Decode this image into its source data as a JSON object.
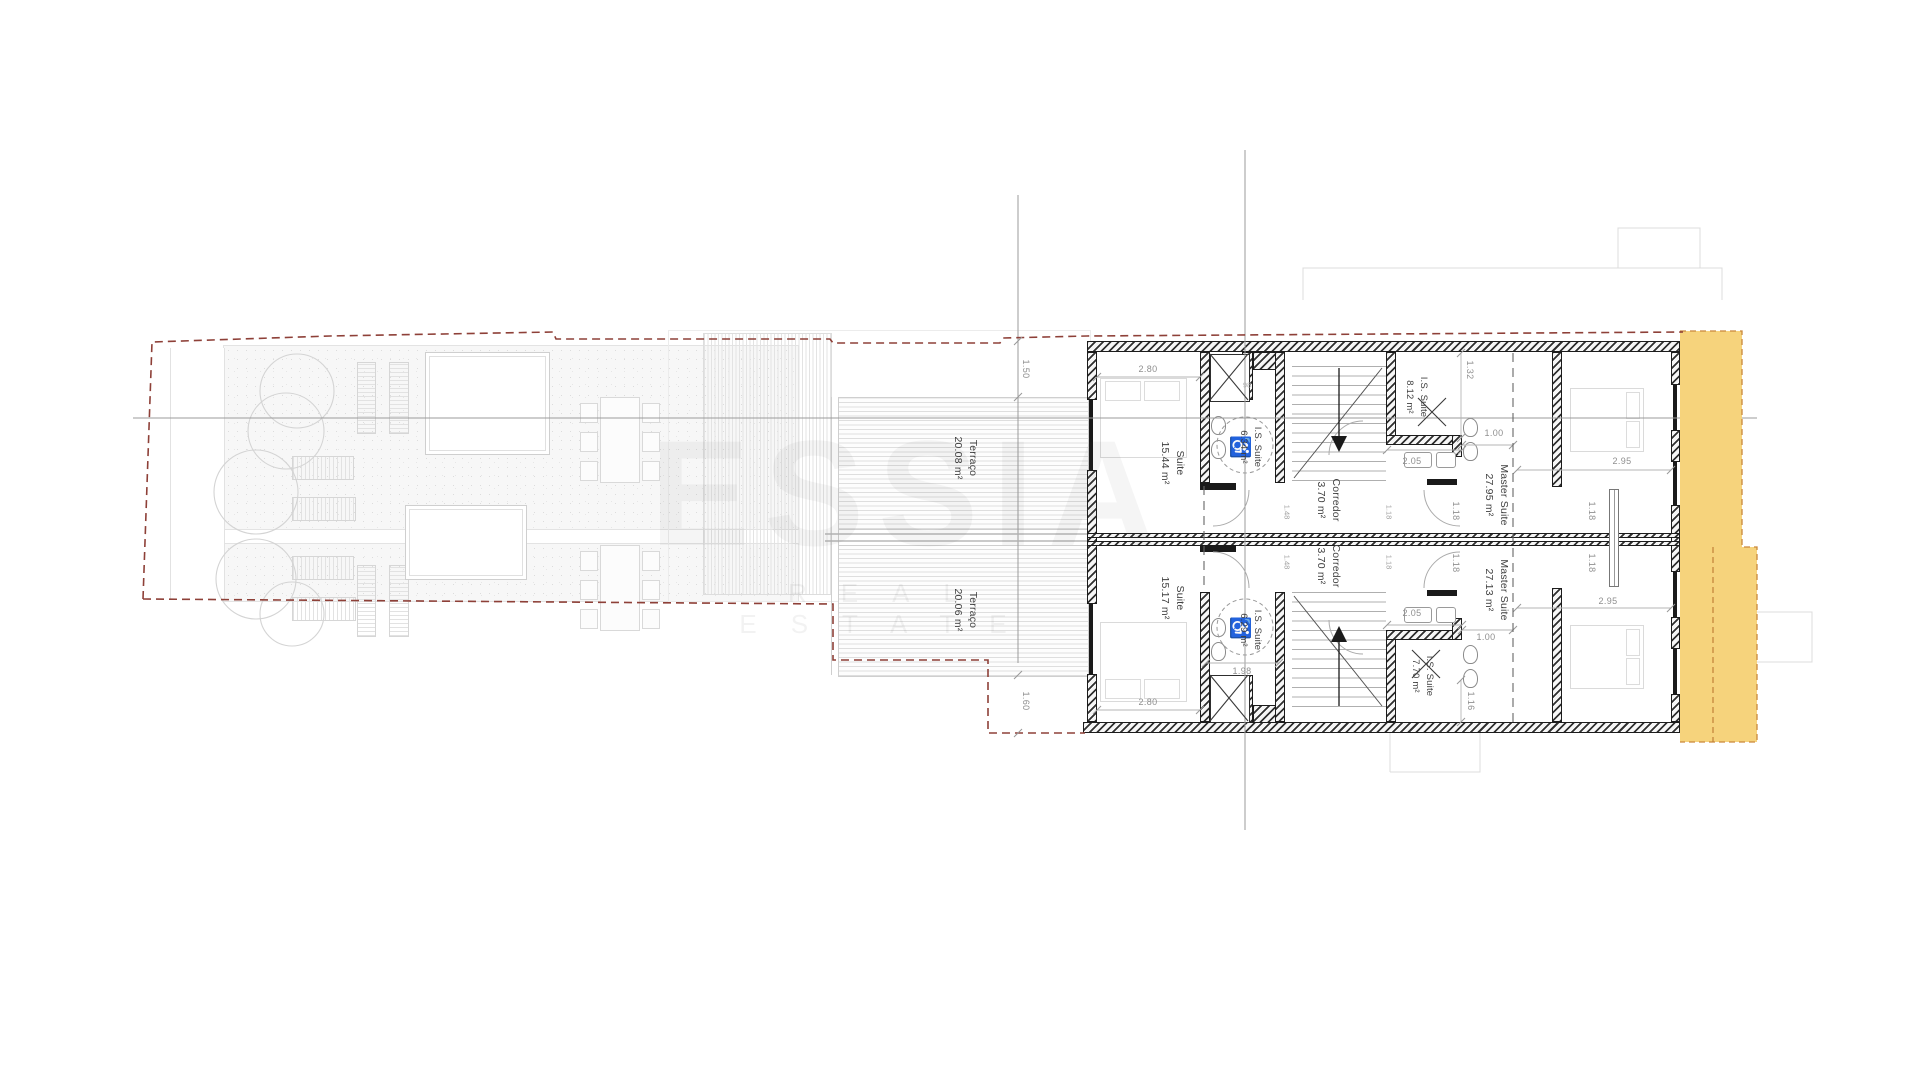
{
  "watermark": {
    "title": "ESSIA",
    "subtitle": "REAL ESTATE"
  },
  "units": [
    {
      "terrace": {
        "name": "Terraço",
        "area": "20.08 m²"
      },
      "suite": {
        "name": "Suite",
        "area": "15.44 m²"
      },
      "is_small": {
        "name": "I.S. Suite",
        "area": "6.34 m²"
      },
      "corridor": {
        "name": "Corredor",
        "area": "3.70 m²"
      },
      "is_suite": {
        "name": "I.S. Suite",
        "area": "8.12 m²"
      },
      "master": {
        "name": "Master Suite",
        "area": "27.95 m²"
      }
    },
    {
      "terrace": {
        "name": "Terraço",
        "area": "20.06 m²"
      },
      "suite": {
        "name": "Suite",
        "area": "15.17 m²"
      },
      "is_small": {
        "name": "I.S. Suite",
        "area": "6.29 m²"
      },
      "corridor": {
        "name": "Corredor",
        "area": "3.70 m²"
      },
      "is_suite": {
        "name": "I.S. Suite",
        "area": "7.70 m²"
      },
      "master": {
        "name": "Master Suite",
        "area": "27.13 m²"
      }
    }
  ],
  "dims": {
    "d150": "1.50",
    "d160": "1.60",
    "d280": [
      "2.80",
      "2.80"
    ],
    "d132": "1.32",
    "d116": "1.16",
    "d100": [
      "1.00",
      "1.00"
    ],
    "d205": [
      "2.05",
      "2.05"
    ],
    "d295": [
      "2.95",
      "2.95"
    ],
    "d118": [
      "1.18",
      "1.18",
      "1.18",
      "1.18"
    ],
    "d148": [
      "1.48",
      "1.48"
    ],
    "d118s": [
      "1.18",
      "1.18"
    ],
    "d198": "1.98",
    "d98": "98"
  },
  "icons": {
    "wheelchair": "♿"
  },
  "colors": {
    "highlight_yellow": "#F6D37C",
    "boundary_red": "#8E4038",
    "highlight_border": "#C9883B"
  }
}
